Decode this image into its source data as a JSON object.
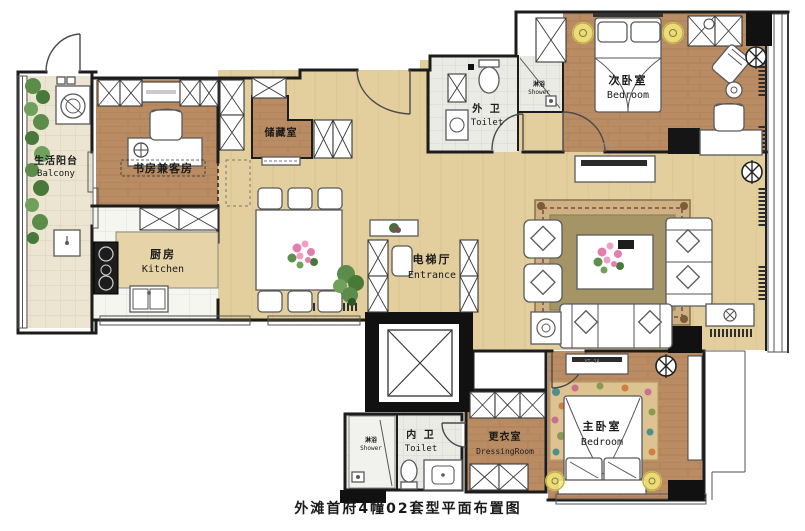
{
  "caption": "外滩首府4幢02套型平面布置图",
  "rooms": {
    "balcony": {
      "cn": "生活阳台",
      "en": "Balcony"
    },
    "study": {
      "cn": "书房兼客房",
      "en": ""
    },
    "storage": {
      "cn": "储藏室",
      "en": ""
    },
    "kitchen": {
      "cn": "厨房",
      "en": "Kitchen"
    },
    "outer_toilet": {
      "cn": "外 卫",
      "en": "Toilet"
    },
    "shower_top": {
      "cn": "淋浴",
      "en": "Shower"
    },
    "bedroom2": {
      "cn": "次卧室",
      "en": "Bedroom"
    },
    "entrance": {
      "cn": "电梯厅",
      "en": "Entrance"
    },
    "inner_toilet": {
      "cn": "内 卫",
      "en": "Toilet"
    },
    "shower_inner": {
      "cn": "淋浴",
      "en": "Shower"
    },
    "dressing": {
      "cn": "更衣室",
      "en": "DressingRoom"
    },
    "master": {
      "cn": "主卧室",
      "en": "Bedroom"
    }
  },
  "floor_codes": {
    "bedroom2": "VT-06",
    "master": "VT-1A"
  },
  "colors": {
    "wood_floor": "#b98c63",
    "light_floor": "#e3cf9e",
    "tile_floor": "#ebebe6",
    "balcony_floor": "#ece5d2",
    "wall": "#1c1c1c",
    "lamp_yellow": "#f3e97f",
    "plant_green": "#5c8c4a",
    "flower_pink": "#e27fae",
    "rug_olive": "#a59566"
  }
}
